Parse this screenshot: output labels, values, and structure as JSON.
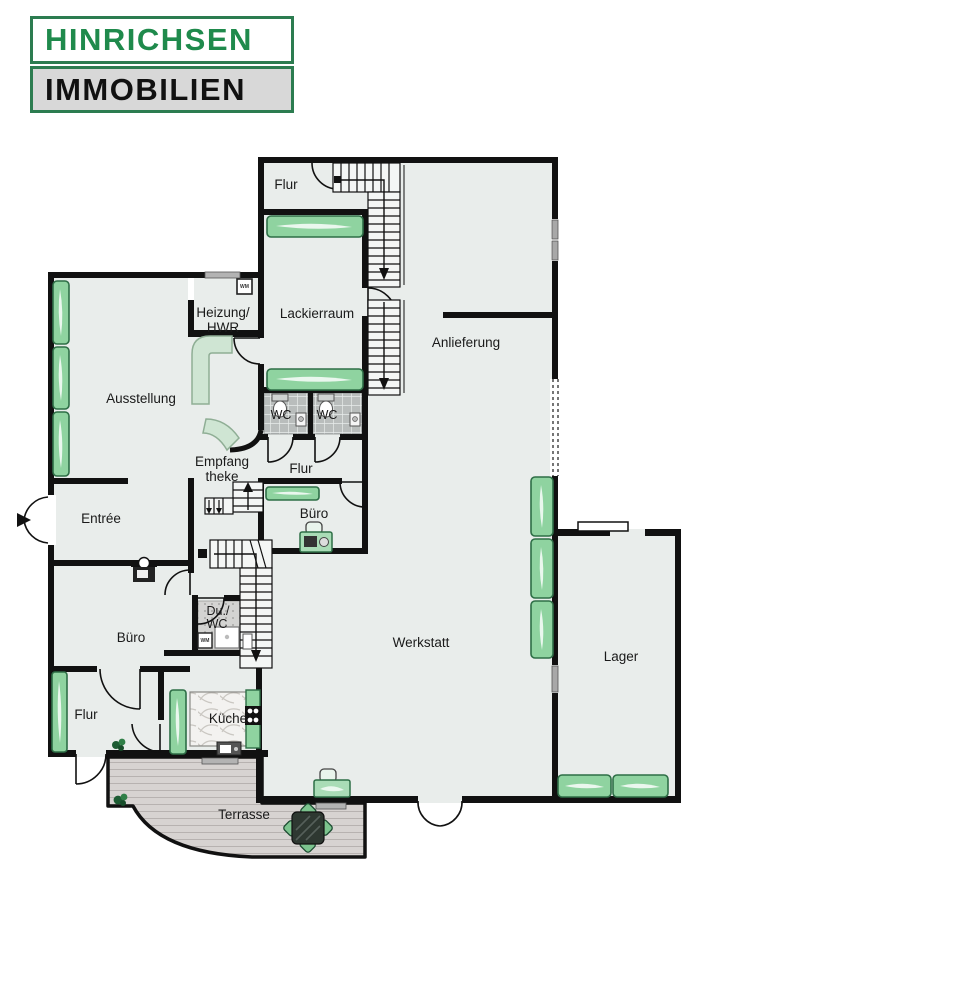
{
  "logo": {
    "line1": "HINRICHSEN",
    "line2": "IMMOBILIEN"
  },
  "rooms": {
    "flur_top": {
      "label": "Flur"
    },
    "lackierraum": {
      "label": "Lackierraum"
    },
    "anlieferung": {
      "label": "Anlieferung"
    },
    "heizung": {
      "label": "Heizung/",
      "label2": "HWR"
    },
    "ausstellung": {
      "label": "Ausstellung"
    },
    "empfang": {
      "label": "Empfang",
      "label2": "theke"
    },
    "wc1": {
      "label": "WC"
    },
    "wc2": {
      "label": "WC"
    },
    "flur_mid": {
      "label": "Flur"
    },
    "entree": {
      "label": "Entrée"
    },
    "buero_small": {
      "label": "Büro"
    },
    "du_wc": {
      "label": "Du./",
      "label2": "WC"
    },
    "buero_left": {
      "label": "Büro"
    },
    "werkstatt": {
      "label": "Werkstatt"
    },
    "lager": {
      "label": "Lager"
    },
    "flur_bottom": {
      "label": "Flur"
    },
    "kueche": {
      "label": "Küche"
    },
    "terrasse": {
      "label": "Terrasse"
    }
  },
  "icons": {
    "wm_label": "WM"
  },
  "colors": {
    "brand_green": "#1f8a4c",
    "logo_gray": "#d8d8d8",
    "floor": "#e9edeb",
    "wall": "#111111",
    "furniture_green": "#8fd3a0",
    "furniture_green_dark": "#2e6e46",
    "pale_green": "#cfe5d3",
    "wc_tile": "#b9bdbc",
    "terrace_deck": "#d7d3d1"
  }
}
